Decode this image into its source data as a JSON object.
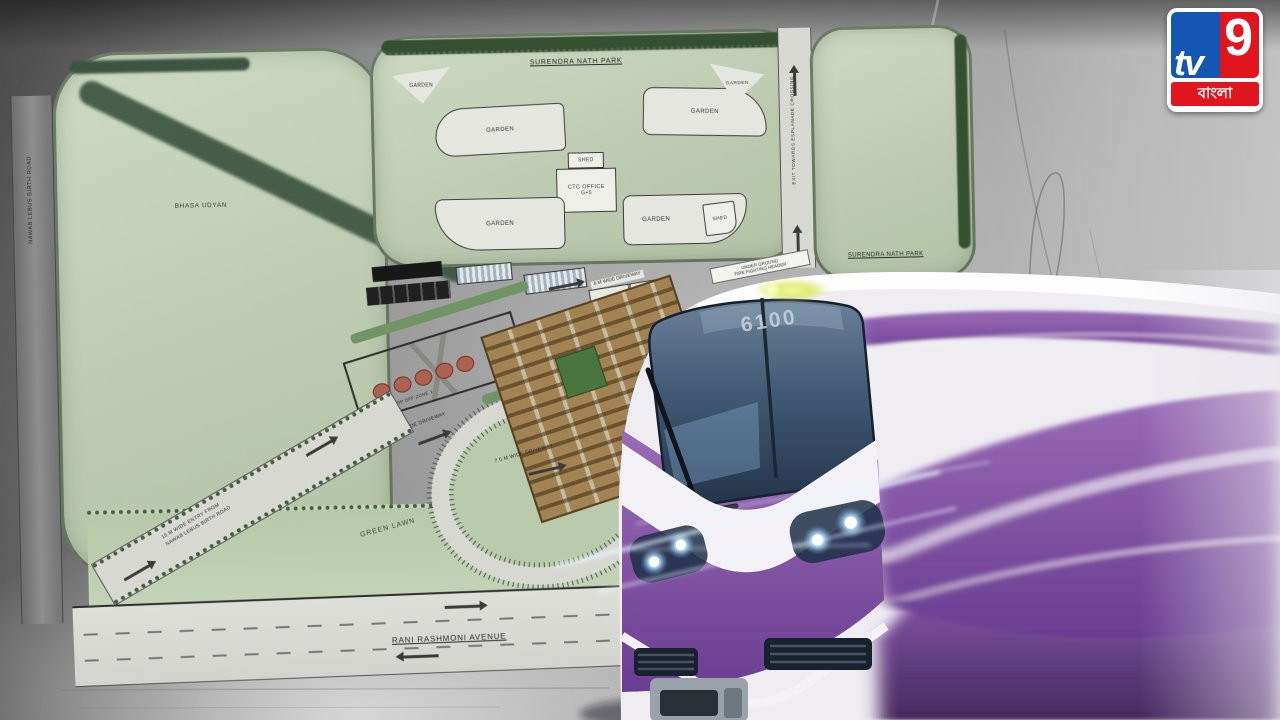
{
  "logo": {
    "tv": "tv",
    "nine": "9",
    "banner": "বাংলা"
  },
  "plan": {
    "parks": {
      "surendra": "SURENDRA NATH PARK",
      "bhasa": "BHASA UDYAN"
    },
    "labels": {
      "garden": "GARDEN",
      "shed": "SHED",
      "ctc_office": "CTC OFFICE",
      "ctc_floors": "G+5",
      "green_lawn": "GREEN LAWN",
      "rani_rashmoni": "RANI RASHMONI AVENUE",
      "exit_road": "EXIT TOWARDS ESPLANADE CROSSING",
      "driveway_10": "10 M WIDE DRIVEWAY",
      "driveway_75": "7.5 M WIDE DRIVEWAY",
      "driveway_6": "6 M WIDE DRIVEWAY",
      "fire_header_1": "UNDER GROUND",
      "fire_header_2": "FIRE FIGHTING HEADER",
      "drop_off": "DROP OFF ZONE 1",
      "entry_1": "15 M WIDE ENTRY FROM",
      "entry_2": "NAWAB LEBUS BIRTH ROAD",
      "left_road": "NAWAB LEBUS BIRTH ROAD"
    }
  },
  "train": {
    "number": "6100"
  },
  "colors": {
    "metro_purple": "#7a4f9c",
    "park_green": "#c6d4ba",
    "tree_green": "#33502f",
    "logo_blue": "#1356b4",
    "logo_red": "#e0151d"
  }
}
